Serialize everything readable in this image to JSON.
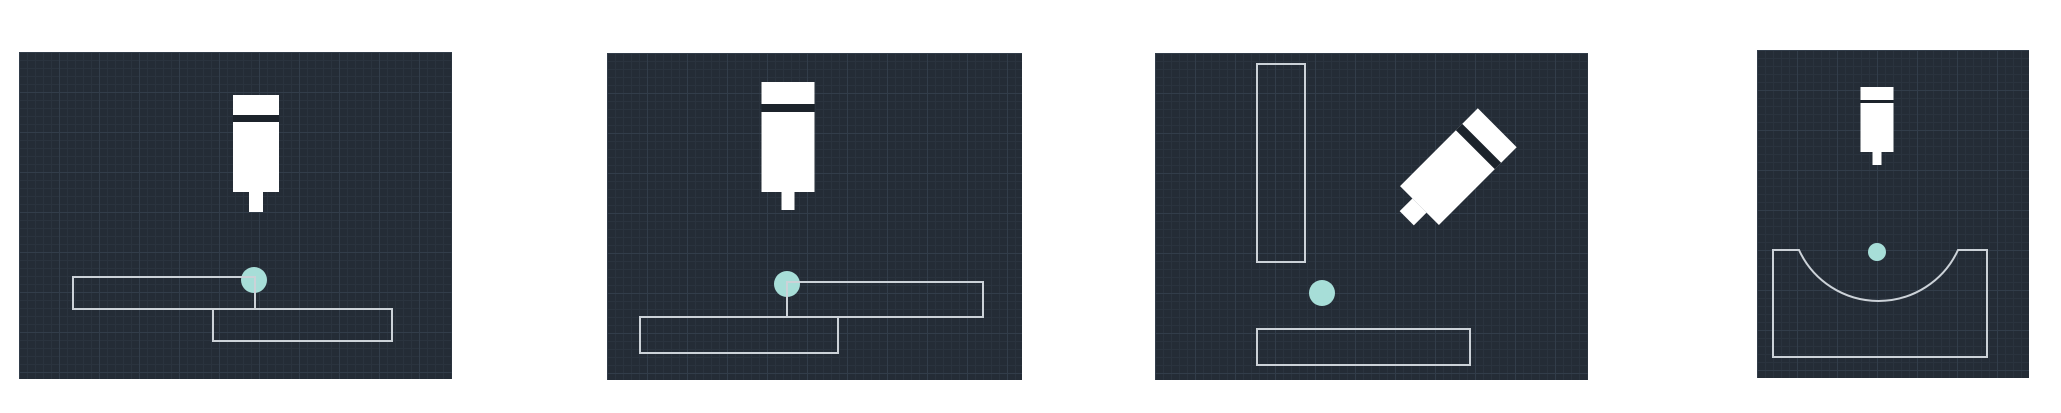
{
  "page": {
    "background": "#ffffff",
    "width": 2061,
    "height": 413
  },
  "style": {
    "panel_bg": "#242c36",
    "grid_minor_color": "#2a333e",
    "grid_major_color": "#323d4a",
    "grid_minor_step": 8,
    "grid_major_step": 40,
    "outline_color": "#ccd2d8",
    "outline_width": 2,
    "dot_color": "#a7ded8",
    "tool_fill": "#ffffff",
    "tool_band_color": "#1c232b"
  },
  "panels": [
    {
      "id": "panel-1",
      "description": "probe tool above two overlapping stepped plate outlines, touch point on upper-left plate corner",
      "x": 19,
      "y": 52,
      "w": 433,
      "h": 327,
      "tool": {
        "icon": "probe-tool-icon",
        "cx": 237,
        "top": 43,
        "body_w": 46,
        "body_h": 97,
        "band_offset": 20,
        "band_h": 7,
        "stem_w": 14,
        "stem_h": 20,
        "rotation": 0
      },
      "dot": {
        "icon": "touch-point-dot",
        "cx": 235,
        "cy": 228,
        "r": 13
      },
      "outlines": [
        {
          "kind": "rect",
          "x": 54,
          "y": 225,
          "w": 182,
          "h": 32
        },
        {
          "kind": "rect",
          "x": 194,
          "y": 257,
          "w": 179,
          "h": 32
        }
      ]
    },
    {
      "id": "panel-2",
      "description": "probe tool above two overlapping stepped plate outlines (mirrored), touch point on upper-right plate corner",
      "x": 607,
      "y": 53,
      "w": 415,
      "h": 327,
      "tool": {
        "icon": "probe-tool-icon",
        "cx": 181,
        "top": 29,
        "body_w": 53,
        "body_h": 110,
        "band_offset": 22,
        "band_h": 8,
        "stem_w": 13,
        "stem_h": 18,
        "rotation": 0
      },
      "dot": {
        "icon": "touch-point-dot",
        "cx": 180,
        "cy": 231,
        "r": 13
      },
      "outlines": [
        {
          "kind": "rect",
          "x": 180,
          "y": 229,
          "w": 196,
          "h": 35
        },
        {
          "kind": "rect",
          "x": 33,
          "y": 264,
          "w": 198,
          "h": 36
        }
      ]
    },
    {
      "id": "panel-3",
      "description": "45-degree angled probe tool beside vertical wall outline and floor plate outline, touch point in inside corner",
      "x": 1155,
      "y": 53,
      "w": 433,
      "h": 327,
      "tool": {
        "icon": "probe-tool-icon",
        "cx": 297,
        "top": 56,
        "body_w": 55,
        "body_h": 110,
        "band_offset": 22,
        "band_h": 9,
        "stem_w": 20,
        "stem_h": 18,
        "rotation": 45
      },
      "dot": {
        "icon": "touch-point-dot",
        "cx": 167,
        "cy": 240,
        "r": 13
      },
      "outlines": [
        {
          "kind": "rect",
          "x": 102,
          "y": 11,
          "w": 48,
          "h": 198
        },
        {
          "kind": "rect",
          "x": 102,
          "y": 276,
          "w": 213,
          "h": 36
        }
      ]
    },
    {
      "id": "panel-4",
      "description": "small probe tool above a block outline with concave circular pocket, touch point above arc center",
      "x": 1757,
      "y": 50,
      "w": 272,
      "h": 328,
      "tool": {
        "icon": "probe-tool-icon",
        "cx": 120,
        "top": 37,
        "body_w": 33,
        "body_h": 65,
        "band_offset": 13,
        "band_h": 3,
        "stem_w": 9,
        "stem_h": 13,
        "rotation": 0
      },
      "dot": {
        "icon": "touch-point-dot",
        "cx": 120,
        "cy": 202,
        "r": 9
      },
      "outlines": [
        {
          "kind": "pocket",
          "x": 16,
          "y": 200,
          "w": 214,
          "h": 107,
          "arc_x1": 42,
          "arc_x2": 201,
          "arc_r": 87.5
        }
      ]
    }
  ]
}
